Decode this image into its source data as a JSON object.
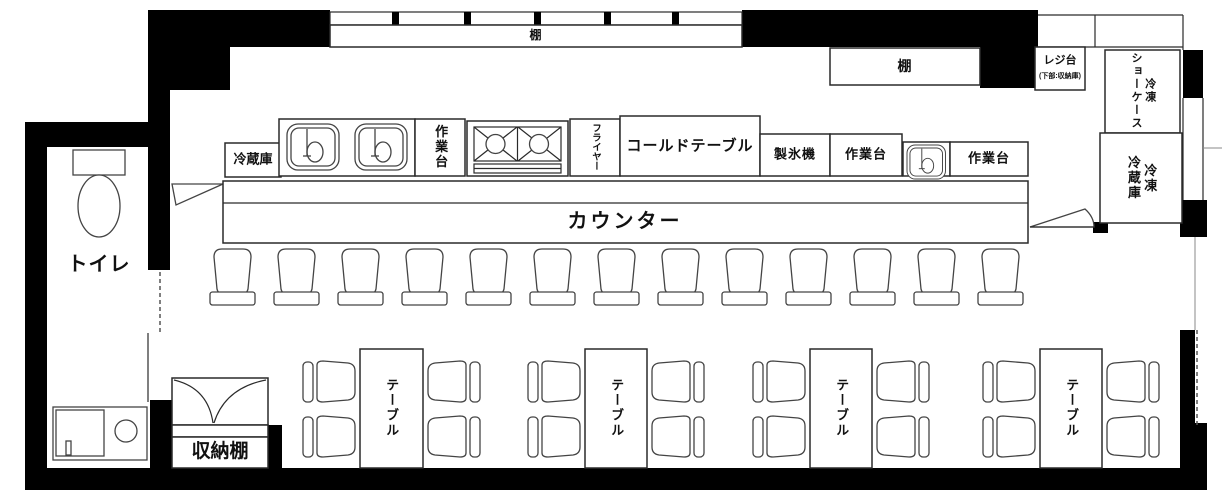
{
  "colors": {
    "wall": "#000000",
    "line": "#2a2a2a",
    "background": "#ffffff"
  },
  "shelves": {
    "top_shelf": "棚",
    "back_shelf": "棚"
  },
  "register": {
    "label": "レジ台",
    "note": "(下部:収納庫)"
  },
  "cold_storage": {
    "refrigerator": "冷蔵庫",
    "freezer_showcase": "冷凍\nショーケース",
    "freezer_refrigerator": "冷凍\n冷蔵庫"
  },
  "kitchen": {
    "work_table_1": "作業台",
    "fryer": "フライヤー",
    "cold_table": "コールドテーブル",
    "ice_maker": "製氷機",
    "work_table_2": "作業台",
    "work_table_3": "作業台"
  },
  "counter": {
    "label": "カウンター",
    "stool_count": 13
  },
  "dining": {
    "table_label": "テーブル",
    "table_count": 4,
    "chairs_per_table": 4
  },
  "rooms": {
    "toilet": "トイレ",
    "storage_shelf": "収納棚"
  }
}
